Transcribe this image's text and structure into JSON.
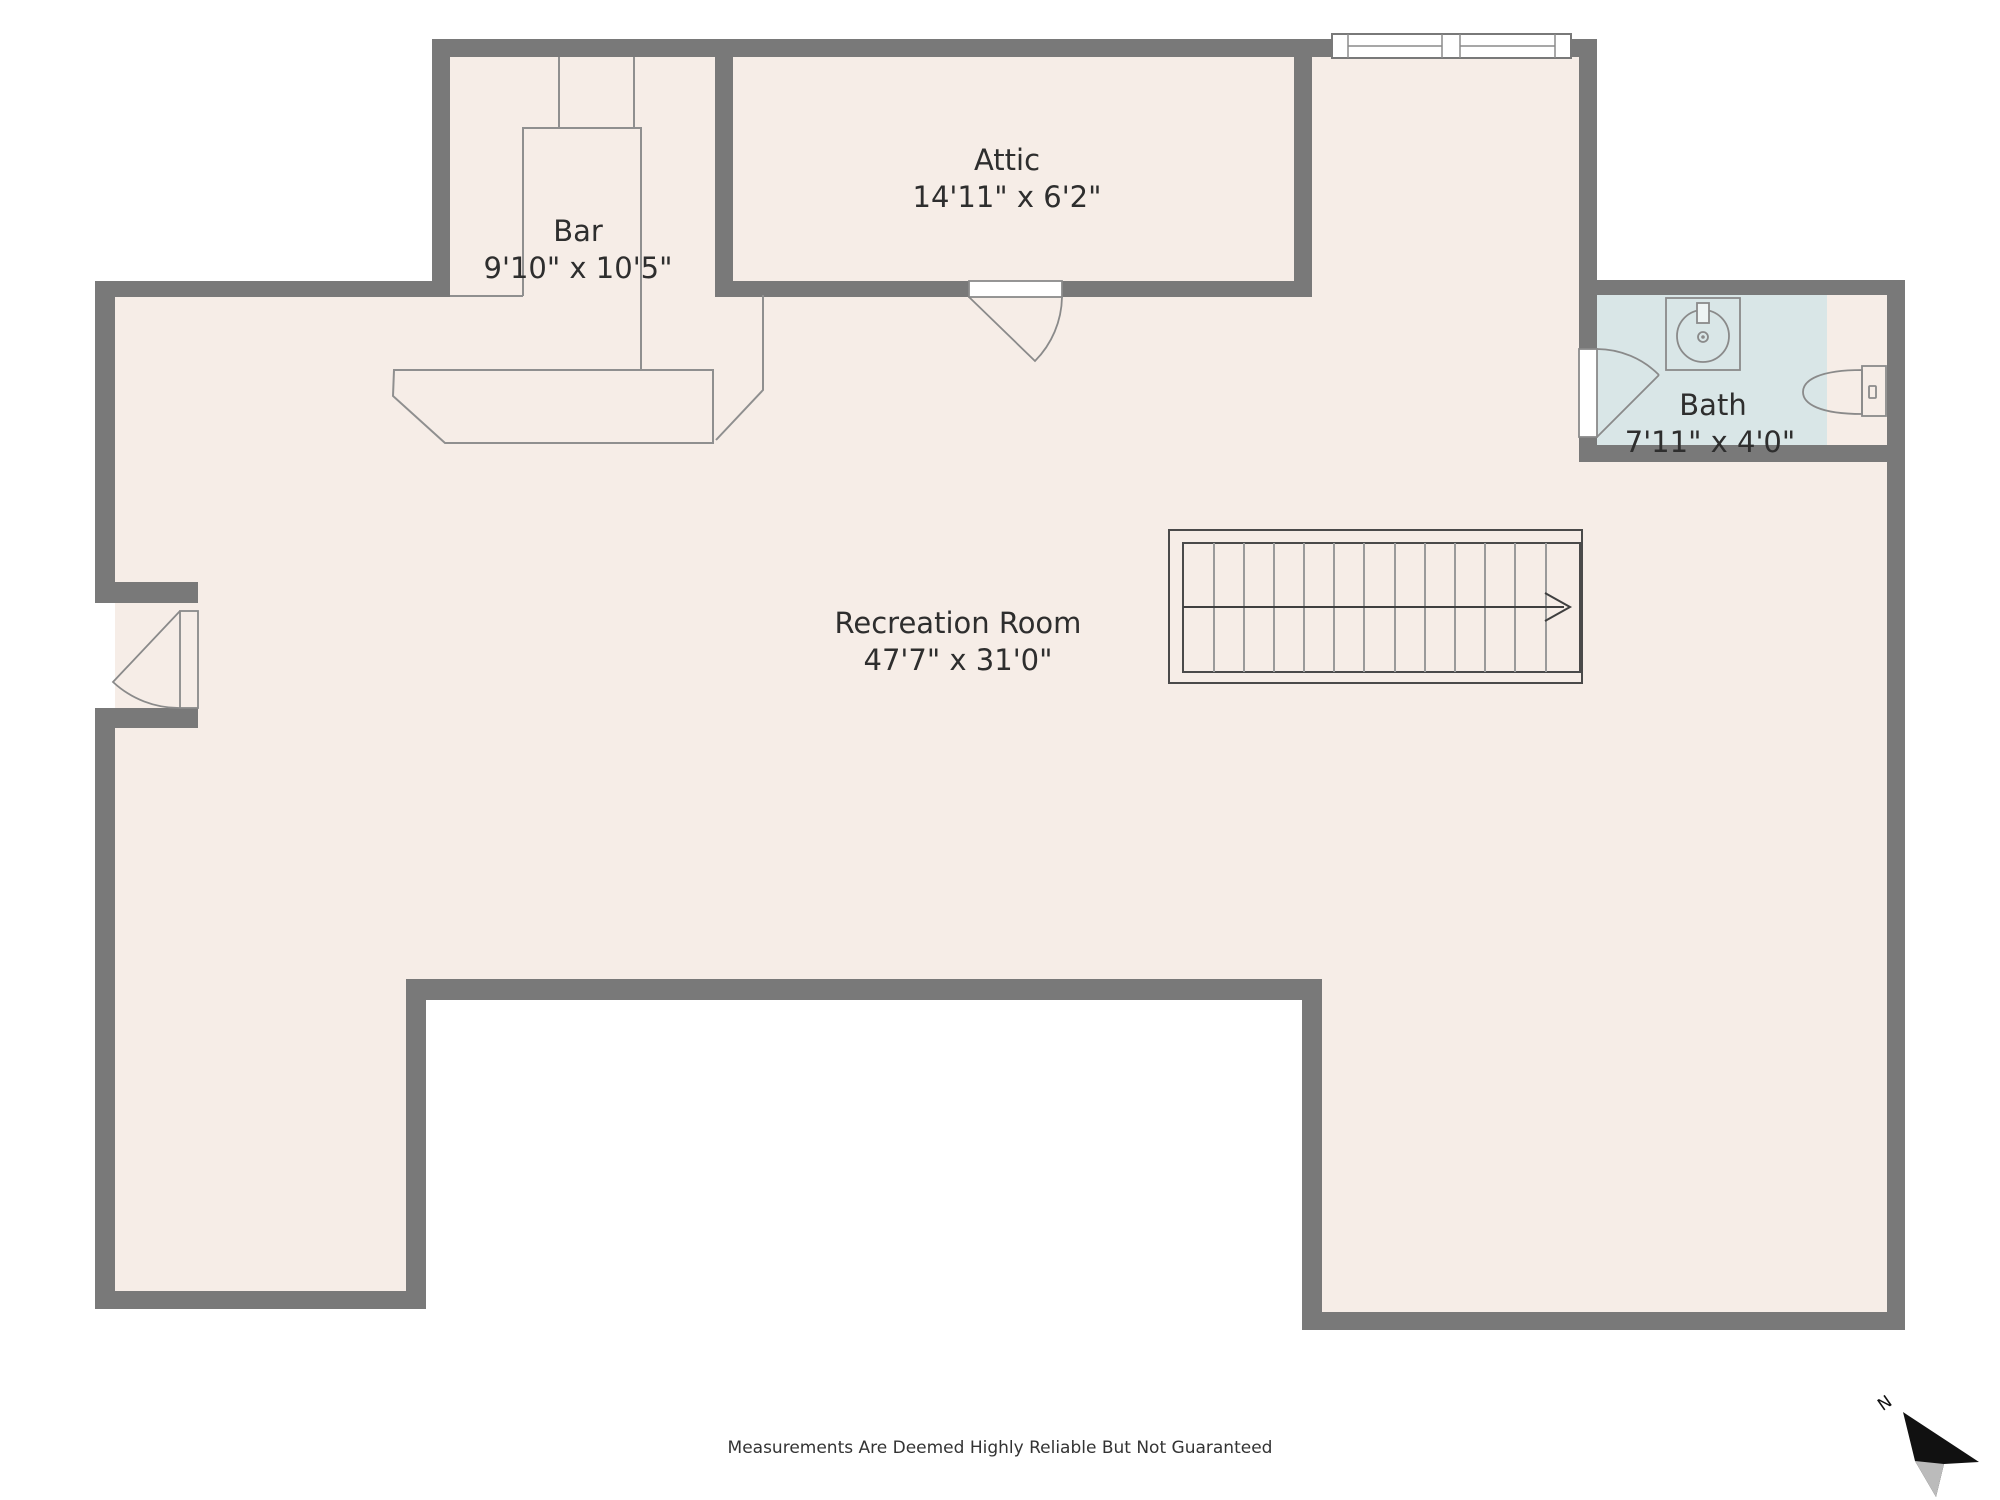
{
  "rooms": {
    "bar": {
      "name": "Bar",
      "dims": "9'10\" x 10'5\""
    },
    "attic": {
      "name": "Attic",
      "dims": "14'11\" x 6'2\""
    },
    "recreation": {
      "name": "Recreation Room",
      "dims": "47'7\" x 31'0\""
    },
    "bath": {
      "name": "Bath",
      "dims": "7'11\" x 4'0\""
    }
  },
  "compass": {
    "label": "N"
  },
  "footer": {
    "disclaimer": "Measurements Are Deemed Highly Reliable But Not Guaranteed"
  },
  "icons": [
    "sink-icon",
    "toilet-icon",
    "north-arrow-icon",
    "stair-direction-arrow-icon",
    "door-swing-icon",
    "window-icon"
  ],
  "colors": {
    "wall": "#797979",
    "floor": "#f6ede7",
    "bath_floor": "#d9e6e7",
    "fixture_line": "#8a8a8a",
    "counter_line": "#8f8f8f",
    "stair_tread": "#9a9a9a",
    "stair_border": "#4a4a4a",
    "arrow_dark": "#3f3f3f",
    "text": "#2e2e2e",
    "compass_black": "#111111",
    "compass_shade": "#bbbbbb",
    "background": "#ffffff"
  }
}
